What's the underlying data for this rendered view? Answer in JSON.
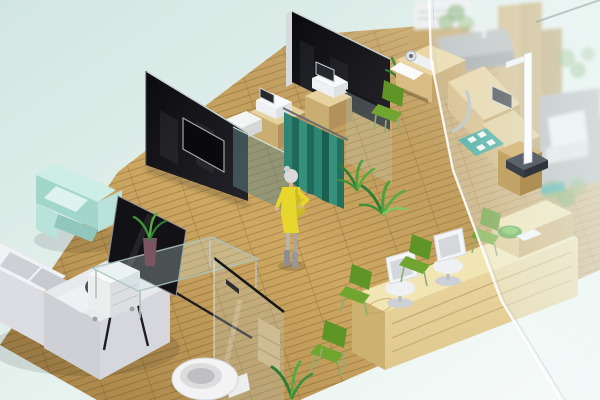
{
  "scene": {
    "description": "Isometric 3D render of a clinic interior floor plan",
    "areas": {
      "waiting_lounge": "sofa, armchair, tv-easel, glass coffee table",
      "exam_room": "wood cabinets with diagnostic devices, teal curtain, black glass partitions",
      "measurement_corner": "exam desk with instruments, stadiometer, teal mat",
      "reception": "long wood reception counter, white task chairs, green visitor chairs",
      "bathroom": "glass door, toilet",
      "behind_glass": "frosted glass wall with blurred furniture"
    },
    "person": {
      "outfit": "yellow dress",
      "hair": "gray bun",
      "pose": "standing by curtain"
    }
  },
  "palette": {
    "bg_top": "#d2e6e1",
    "bg_mid": "#e6f2ee",
    "bg_bottom": "#f7fbf9",
    "floor": "#cfa963",
    "wall_black": "#0b0b0f",
    "wall_black_lit": "#232329",
    "glass_teal": "rgba(96,136,138,0.5)",
    "curtain": "#2e8573",
    "curtain_dark": "#1f6a5a",
    "sofa_light": "#eef0f3",
    "sofa_mid": "#d9dade",
    "armchair": "#b9e2da",
    "armchair_dark": "#a3d6cb",
    "chair_green": "#5f9427",
    "chair_green_seat": "#70a630",
    "wood_top": "#e6d29e",
    "wood_left": "#c9ae74",
    "wood_right": "#b2925a",
    "desk_top": "#f2e5b4",
    "desk_front": "#dfc88e",
    "device_white": "#eef0f1",
    "screen_dark": "#25282d",
    "mat_teal": "#2a9d8f",
    "plant_green": "#3f8f3a",
    "plant_light": "#57ab3f",
    "dress_yellow": "#e7d62c",
    "hair_gray": "#d9d9d9",
    "skin": "#d9b38c",
    "toilet_white": "#f3f3f4",
    "metal_dark": "#1d1d22",
    "platform_dark": "#5a626b",
    "frost": "rgba(238,247,246,0.62)"
  }
}
